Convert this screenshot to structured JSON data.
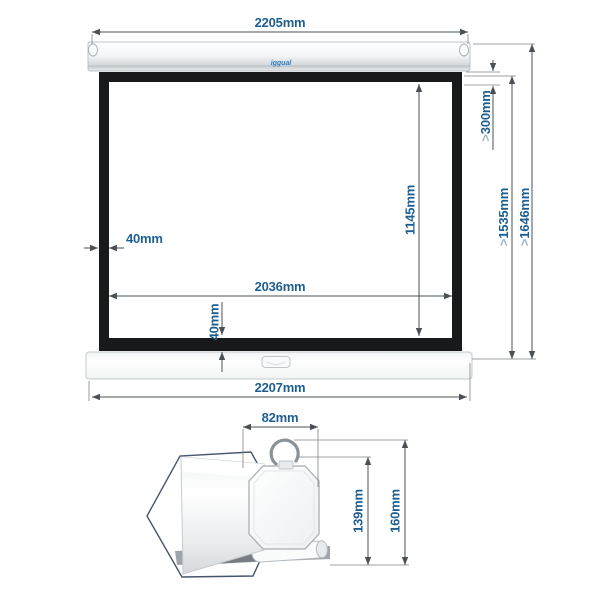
{
  "front_view": {
    "logo_text": "iggual",
    "dim_top_width": "2205mm",
    "dim_bottom_width": "2207mm",
    "dim_viewing_width": "2036mm",
    "dim_viewing_height": "1145mm",
    "dim_side_border": "40mm",
    "dim_bottom_border": "40mm",
    "dim_black_drop": {
      "prefix": ">",
      "value": "300mm"
    },
    "dim_fabric_height": {
      "prefix": ">",
      "value": "1535mm"
    },
    "dim_total_height": {
      "prefix": ">",
      "value": "1646mm"
    }
  },
  "detail_view": {
    "dim_case_width": "82mm",
    "dim_case_height": "139mm",
    "dim_total_height": "160mm"
  },
  "colors": {
    "dimension_text": "#1e5f93",
    "greater_than_chevron": "#9fb3c0",
    "dimension_line": "#4a5055",
    "screen_frame": "#17191b",
    "casing": "#e8eaec"
  }
}
